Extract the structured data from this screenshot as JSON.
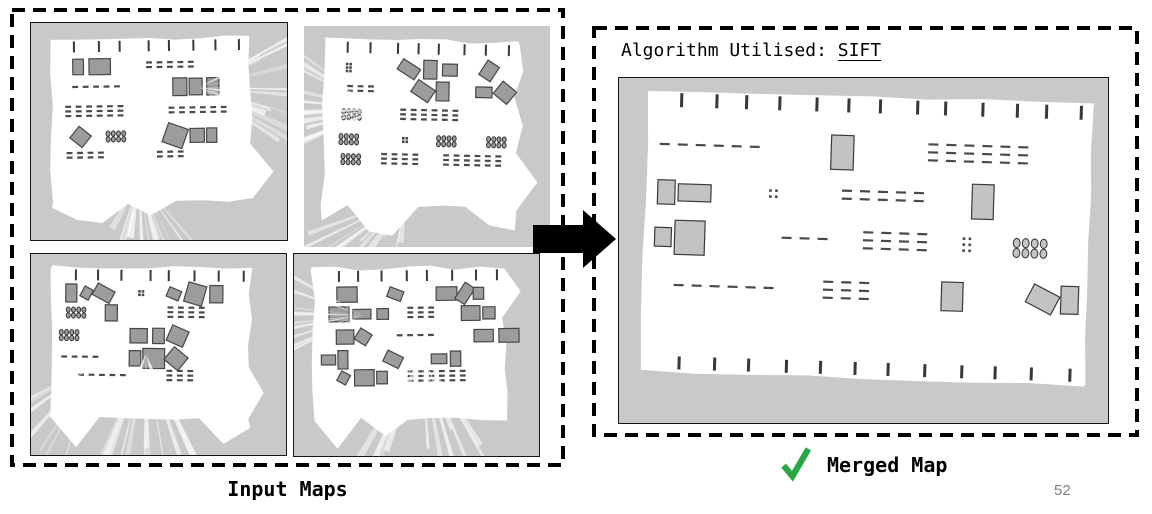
{
  "slide": {
    "page_number": "52"
  },
  "input_section": {
    "label": "Input Maps",
    "description": "2x2 grid of robot occupancy-grid maps with exploration rays"
  },
  "output_section": {
    "title_prefix": "Algorithm Utilised: ",
    "algorithm": "SIFT",
    "caption": "Merged Map",
    "check_icon": "green-checkmark"
  },
  "colors": {
    "map_unknown": "#c9c9c9",
    "map_free": "#ffffff",
    "input_block_fill": "#9c9c9c",
    "input_block_stroke": "#464646",
    "merged_block_fill": "#c3c3c3",
    "merged_block_stroke": "#3a3a3a",
    "dash": "#4a4a4a",
    "tick": "#222222",
    "check_green": "#27a844",
    "arrow": "#000000",
    "dashed_border": "#000000",
    "page_number_gray": "#808080"
  },
  "maps": {
    "items": [
      {
        "id": "input-map-top-left",
        "kind": "input",
        "seed": 11,
        "rot": -0.8,
        "rays": [
          {
            "x": 0.66,
            "y": 0.3,
            "a0": -35,
            "a1": 35,
            "n": 15
          },
          {
            "x": 0.42,
            "y": 0.72,
            "a0": 45,
            "a1": 125,
            "n": 13
          }
        ]
      },
      {
        "id": "input-map-top-right",
        "kind": "input",
        "seed": 29,
        "rot": 1.2,
        "rays": [
          {
            "x": 0.3,
            "y": 0.38,
            "a0": 150,
            "a1": 215,
            "n": 14
          },
          {
            "x": 0.42,
            "y": 0.78,
            "a0": 95,
            "a1": 175,
            "n": 11
          }
        ]
      },
      {
        "id": "input-map-bottom-left",
        "kind": "input",
        "seed": 47,
        "rot": 0.5,
        "rays": [
          {
            "x": 0.45,
            "y": 0.5,
            "a0": 55,
            "a1": 125,
            "n": 16
          },
          {
            "x": 0.25,
            "y": 0.55,
            "a0": 100,
            "a1": 155,
            "n": 8
          }
        ]
      },
      {
        "id": "input-map-bottom-right",
        "kind": "input",
        "seed": 63,
        "rot": -0.6,
        "rays": [
          {
            "x": 0.52,
            "y": 0.48,
            "a0": 55,
            "a1": 130,
            "n": 15
          },
          {
            "x": 0.28,
            "y": 0.3,
            "a0": 150,
            "a1": 215,
            "n": 10
          }
        ]
      },
      {
        "id": "merged-map",
        "kind": "merged",
        "seed": 5,
        "rot": 1.8,
        "rays": []
      }
    ]
  }
}
